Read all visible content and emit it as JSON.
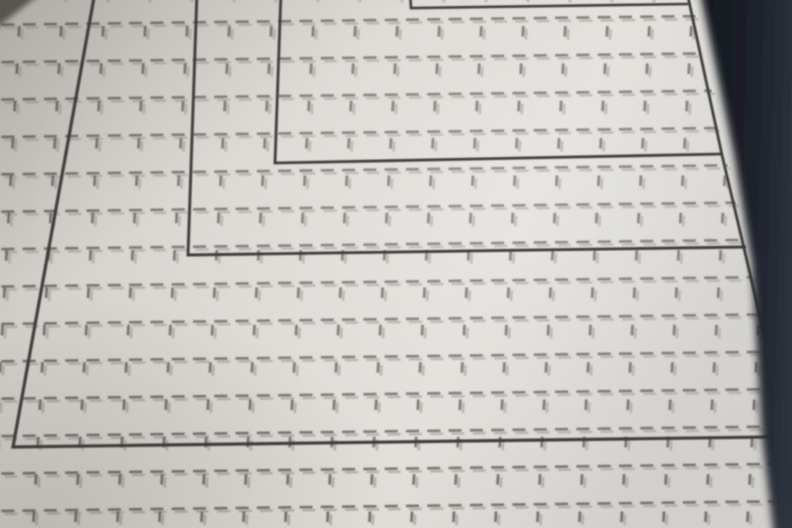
{
  "mat": {
    "sizes": [
      {
        "code": "B7",
        "dimensions": "91mm x128mm"
      },
      {
        "code": "B6",
        "dimensions": "128mm x182mm"
      },
      {
        "code": "A5",
        "dimensions": "148mm x210mm"
      },
      {
        "code": "B5",
        "dimensions": "182mm x257mm"
      }
    ],
    "colors": {
      "mat_base": "#d9d6d1",
      "grid_dash": "#6f6b65",
      "grid_dash_shadow": "#b2afa9",
      "outline": "#3e3d3b",
      "label_text": "#3a3938",
      "label_dims": "#55534f",
      "edge_dark": "#1d212a",
      "corner_shadow": "#4f4c47"
    }
  }
}
